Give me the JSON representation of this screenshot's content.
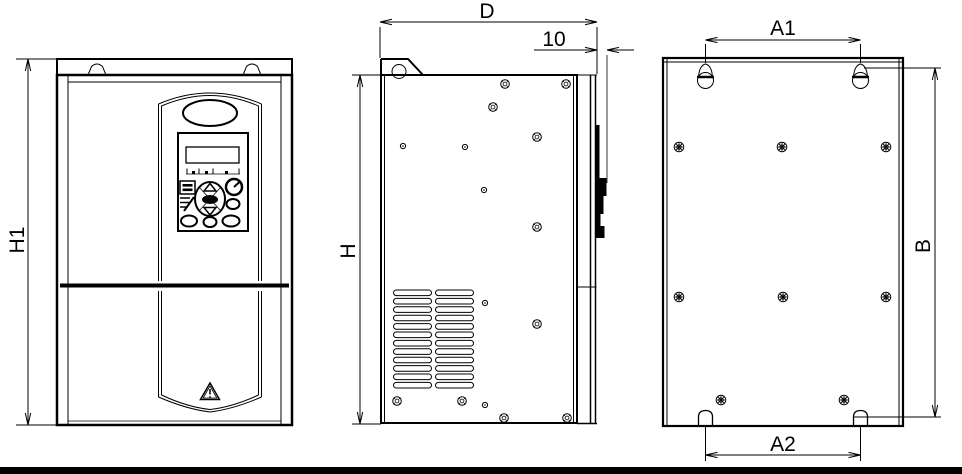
{
  "page": {
    "background": "#ffffff",
    "line_color": "#000000",
    "footer_bar_color": "#000000"
  },
  "drawing": {
    "kind": "inverter-outline-and-mounting-dimension-drawing",
    "views": [
      {
        "id": "front-view",
        "dimension_labels": [
          "H1"
        ]
      },
      {
        "id": "side-view",
        "dimension_labels": [
          "D",
          "10",
          "H"
        ]
      },
      {
        "id": "back-view",
        "dimension_labels": [
          "A1",
          "B",
          "A2"
        ]
      }
    ]
  },
  "dimensions": {
    "h1": "H1",
    "d": "D",
    "back_clearance": "10",
    "h": "H",
    "a1": "A1",
    "b": "B",
    "a2": "A2"
  }
}
